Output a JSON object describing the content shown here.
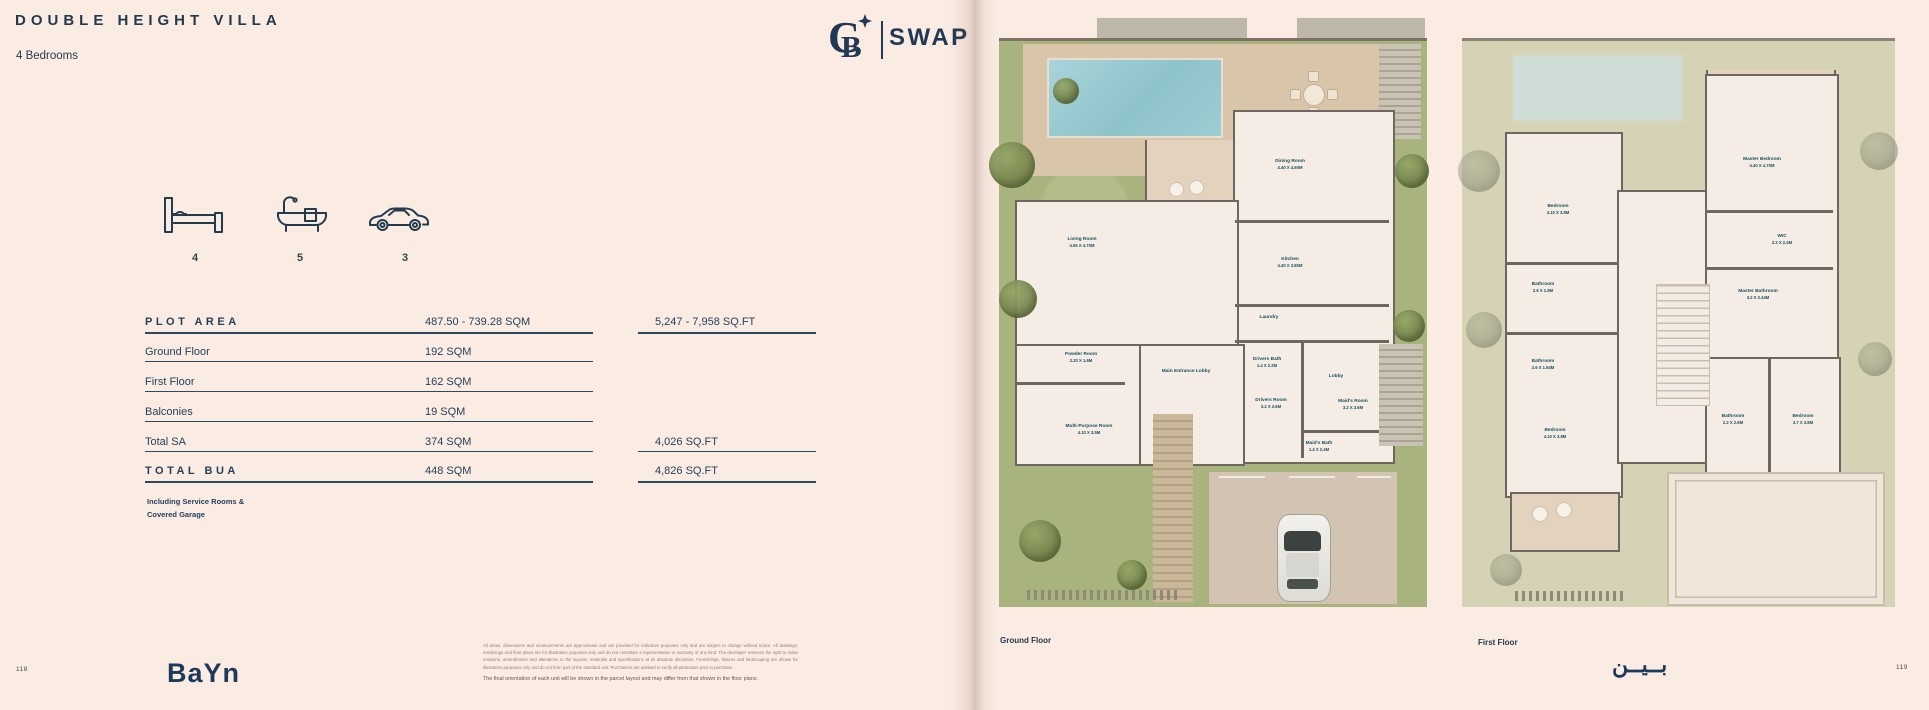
{
  "page": {
    "title": "DOUBLE HEIGHT VILLA",
    "subtitle": "4 Bedrooms",
    "left_page_number": "118",
    "right_page_number": "119"
  },
  "brand": {
    "monogram": "CB",
    "name": "SWAP",
    "footer_logo": "BaYn",
    "footer_logo_arabic": "بــيــن"
  },
  "stats": {
    "beds": "4",
    "baths": "5",
    "parking": "3"
  },
  "area_table": {
    "rows": [
      {
        "label": "PLOT AREA",
        "sqm": "487.50 - 739.28 SQM",
        "sqft": "5,247 - 7,958 SQ.FT"
      },
      {
        "label": "Ground Floor",
        "sqm": "192 SQM"
      },
      {
        "label": "First Floor",
        "sqm": "162 SQM"
      },
      {
        "label": "Balconies",
        "sqm": "19 SQM"
      },
      {
        "label": "Total  SA",
        "sqm": "374 SQM",
        "sqft": "4,026 SQ.FT"
      },
      {
        "label": "TOTAL BUA",
        "sqm": "448 SQM",
        "sqft": "4,826 SQ.FT"
      }
    ],
    "note_line1": "Including Service Rooms &",
    "note_line2": "Covered Garage"
  },
  "disclaimer": {
    "fine_print": "All areas, dimensions and measurements are approximate and are provided for indicative purposes only and are subject to change without notice. All drawings, renderings and floor plans are for illustrative purposes only and do not constitute a representation or warranty of any kind. The developer reserves the right to make revisions, amendments and alterations to the layouts, materials and specifications at its absolute discretion. Furnishings, fixtures and landscaping are shown for illustration purposes only and do not form part of the standard unit. Purchasers are advised to verify all particulars prior to purchase.",
    "final_line": "The final orientation of each unit will be shown in the parcel layout and may differ from that shown in the floor plans."
  },
  "plans": {
    "ground": {
      "label": "Ground Floor",
      "rooms": [
        {
          "name": "Dining Room",
          "dims": "4.40 X 4.60M"
        },
        {
          "name": "Living Room",
          "dims": "4.55 X 4.70M"
        },
        {
          "name": "Kitchen",
          "dims": "4.40 X 3.80M"
        },
        {
          "name": "Laundry",
          "dims": ""
        },
        {
          "name": "Powder Room",
          "dims": "2.20 X 1.6M"
        },
        {
          "name": "Main Entrance Lobby",
          "dims": ""
        },
        {
          "name": "Drivers Bath",
          "dims": "1.4 X 2.2M"
        },
        {
          "name": "Drivers Room",
          "dims": "3.2 X 3.6M"
        },
        {
          "name": "Lobby",
          "dims": ""
        },
        {
          "name": "Maid's Room",
          "dims": "3.2 X 3.6M"
        },
        {
          "name": "Maid's Bath",
          "dims": "1.4 X 2.4M"
        },
        {
          "name": "Multi-Purpose Room",
          "dims": "4.10 X 3.5M"
        }
      ]
    },
    "first": {
      "label": "First Floor",
      "rooms": [
        {
          "name": "Master Bedroom",
          "dims": "4.40 X 4.70M"
        },
        {
          "name": "Bedroom",
          "dims": "4.10 X 3.8M"
        },
        {
          "name": "WIC",
          "dims": "2.2 X 2.4M"
        },
        {
          "name": "Bathroom",
          "dims": "2.6 X 1.9M"
        },
        {
          "name": "Master Bathroom",
          "dims": "3.2 X 2.44M"
        },
        {
          "name": "Bathroom",
          "dims": "2.6 X 1.94M"
        },
        {
          "name": "Bedroom",
          "dims": "4.10 X 3.8M"
        },
        {
          "name": "Bathroom",
          "dims": "2.2 X 2.6M"
        },
        {
          "name": "Bedroom",
          "dims": "3.7 X 3.8M"
        }
      ]
    }
  },
  "colors": {
    "navy": "#23394d",
    "garden_green": "#a9b37e",
    "pool_blue": "#9fcfd5",
    "deck_tan": "#d9c6aa",
    "wall_gray": "#6f6660"
  }
}
